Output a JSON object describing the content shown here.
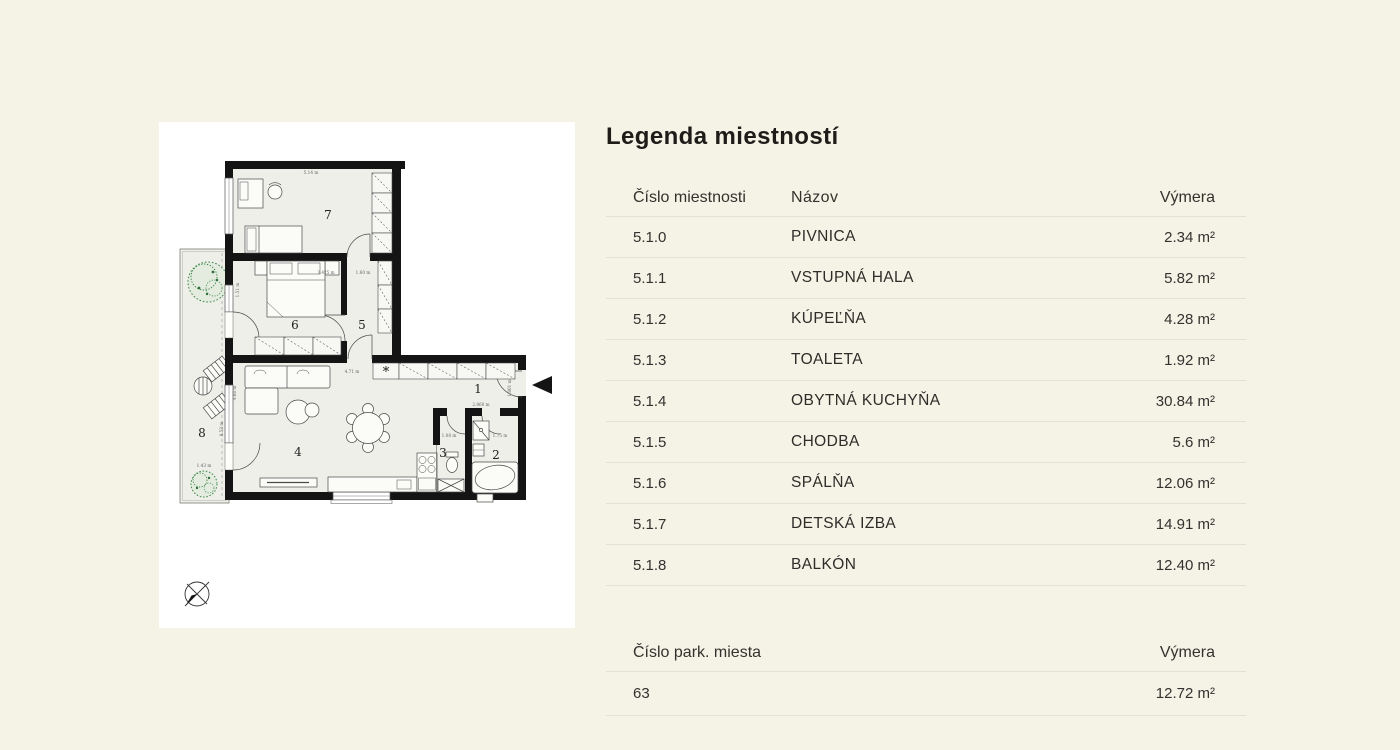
{
  "legend": {
    "title": "Legenda miestností",
    "rooms_table": {
      "headers": {
        "number": "Číslo miestnosti",
        "name": "Názov",
        "area": "Výmera"
      },
      "rows": [
        {
          "number": "5.1.0",
          "name": "PIVNICA",
          "area": "2.34 m²"
        },
        {
          "number": "5.1.1",
          "name": "VSTUPNÁ HALA",
          "area": "5.82 m²"
        },
        {
          "number": "5.1.2",
          "name": "KÚPEĽŇA",
          "area": "4.28 m²"
        },
        {
          "number": "5.1.3",
          "name": "TOALETA",
          "area": "1.92 m²"
        },
        {
          "number": "5.1.4",
          "name": "OBYTNÁ KUCHYŇA",
          "area": "30.84 m²"
        },
        {
          "number": "5.1.5",
          "name": "CHODBA",
          "area": "5.6 m²"
        },
        {
          "number": "5.1.6",
          "name": "SPÁLŇA",
          "area": "12.06 m²"
        },
        {
          "number": "5.1.7",
          "name": "DETSKÁ IZBA",
          "area": "14.91 m²"
        },
        {
          "number": "5.1.8",
          "name": "BALKÓN",
          "area": "12.40 m²"
        }
      ]
    },
    "parking_table": {
      "headers": {
        "number": "Číslo park. miesta",
        "area": "Výmera"
      },
      "rows": [
        {
          "number": "63",
          "area": "12.72 m²"
        }
      ]
    }
  },
  "floorplan": {
    "closet_marker": "*",
    "room_numbers": [
      {
        "label": "7",
        "x": 169,
        "y": 97
      },
      {
        "label": "6",
        "x": 136,
        "y": 207
      },
      {
        "label": "5",
        "x": 203,
        "y": 207
      },
      {
        "label": "4",
        "x": 139,
        "y": 334
      },
      {
        "label": "1",
        "x": 319,
        "y": 271
      },
      {
        "label": "3",
        "x": 284,
        "y": 335
      },
      {
        "label": "2",
        "x": 337,
        "y": 337
      },
      {
        "label": "8",
        "x": 43,
        "y": 315
      }
    ],
    "dim_labels": [
      {
        "text": "5.14 m",
        "x": 152,
        "y": 52,
        "rot": 0
      },
      {
        "text": "3.425 m",
        "x": 167,
        "y": 152,
        "rot": 0
      },
      {
        "text": "1.60 m",
        "x": 204,
        "y": 152,
        "rot": 0
      },
      {
        "text": "1.51 m",
        "x": 80,
        "y": 168,
        "rot": -90
      },
      {
        "text": "4.71 m",
        "x": 193,
        "y": 251,
        "rot": 0
      },
      {
        "text": "2.860 m",
        "x": 322,
        "y": 284,
        "rot": 0
      },
      {
        "text": "1.801 m",
        "x": 352,
        "y": 266,
        "rot": -90
      },
      {
        "text": "1.08 m",
        "x": 290,
        "y": 315,
        "rot": 0
      },
      {
        "text": "1.75 m",
        "x": 341,
        "y": 315,
        "rot": 0
      },
      {
        "text": "4.68 m",
        "x": 77,
        "y": 271,
        "rot": -90
      },
      {
        "text": "8.53 m",
        "x": 64,
        "y": 307,
        "rot": -90
      },
      {
        "text": "1.43 m",
        "x": 45,
        "y": 345,
        "rot": 0
      }
    ],
    "colors": {
      "wall": "#141414",
      "room_fill": "#edefe8",
      "tree": "#3c8549"
    }
  }
}
